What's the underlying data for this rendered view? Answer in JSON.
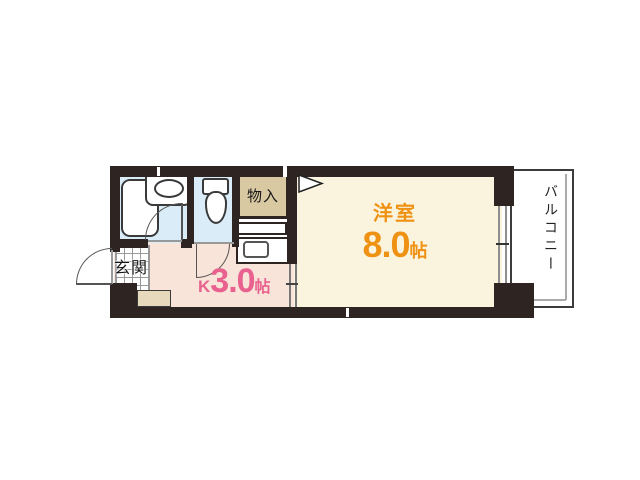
{
  "rooms": {
    "western_room": {
      "label": "洋室",
      "area": "8.0",
      "unit": "帖"
    },
    "kitchen": {
      "label": "K",
      "area": "3.0",
      "unit": "帖"
    },
    "entrance": {
      "label": "玄関"
    },
    "closet": {
      "label": "物入"
    },
    "balcony": {
      "label": "バルコニー"
    }
  },
  "colors": {
    "wall": "#2e2522",
    "western_room_floor": "#faf4df",
    "kitchen_floor": "#f8e4d8",
    "wet_area_floor": "#d9ecf7",
    "closet_fill": "#d9c9a3",
    "step_fill": "#e7dabc",
    "western_room_label": "#ef9112",
    "kitchen_label": "#e8618f",
    "balcony_text": "#222222"
  },
  "fixtures": {
    "bathtub": "bathtub",
    "bathroom_sink": "sink",
    "toilet": "toilet",
    "kitchen_counter": "kitchen-counter-with-sink"
  }
}
